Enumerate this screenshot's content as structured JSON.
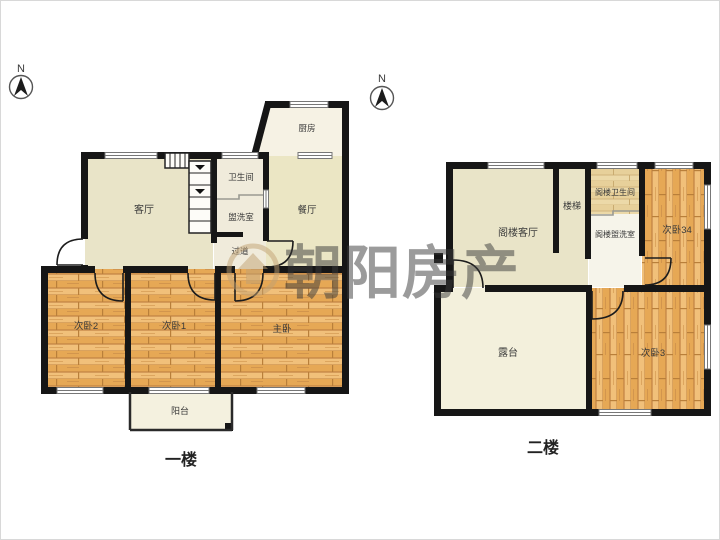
{
  "watermark": {
    "text": "朝阳房产"
  },
  "compass": {
    "label": "N"
  },
  "floor1": {
    "name": "一楼",
    "rooms": {
      "living": "客厅",
      "bath": "卫生间",
      "wash": "盥洗室",
      "hallway": "过道",
      "kitchen": "厨房",
      "dining": "餐厅",
      "bedroom2": "次卧2",
      "bedroom1": "次卧1",
      "master": "主卧",
      "balcony": "阳台"
    }
  },
  "floor2": {
    "name": "二楼",
    "rooms": {
      "attic_living": "阁楼客厅",
      "stairs": "楼梯",
      "attic_bath": "阁楼卫生间",
      "attic_wash": "阁楼盥洗室",
      "bedroom34": "次卧34",
      "terrace": "露台",
      "bedroom3": "次卧3"
    }
  },
  "colors": {
    "wall": "#161616",
    "cream_room": "#e9e4c8",
    "light_room": "#f3f0dc",
    "wood_base": "#e9ad5c",
    "watermark": "#c2a273"
  }
}
